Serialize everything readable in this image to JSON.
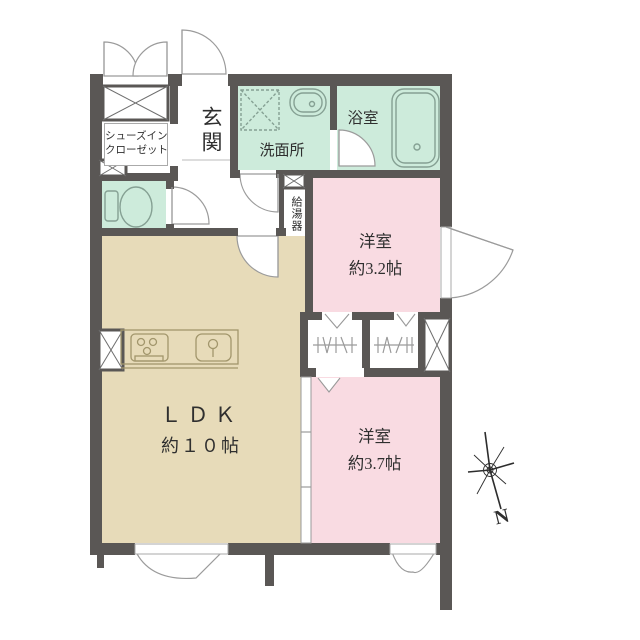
{
  "colors": {
    "wall": "#5a5755",
    "mint": "#cdebdb",
    "pink": "#f9dbe2",
    "tan": "#e7dbb9",
    "line": "#85a093",
    "kitchen": "#a2966c",
    "text": "#2f2f2f"
  },
  "rooms": {
    "entrance": {
      "label": "玄関"
    },
    "shoe_closet": {
      "line1": "シューズイン",
      "line2": "クローゼット"
    },
    "washroom": {
      "label": "洗面所"
    },
    "bathroom": {
      "label": "浴室"
    },
    "water_heater": {
      "label": "給湯器"
    },
    "bedroom_a": {
      "name": "洋室",
      "area": "約3.2帖"
    },
    "bedroom_b": {
      "name": "洋室",
      "area": "約3.7帖"
    },
    "ldk": {
      "name": "ＬＤＫ",
      "area": "約１０帖"
    }
  },
  "compass": {
    "north_label": "N"
  }
}
